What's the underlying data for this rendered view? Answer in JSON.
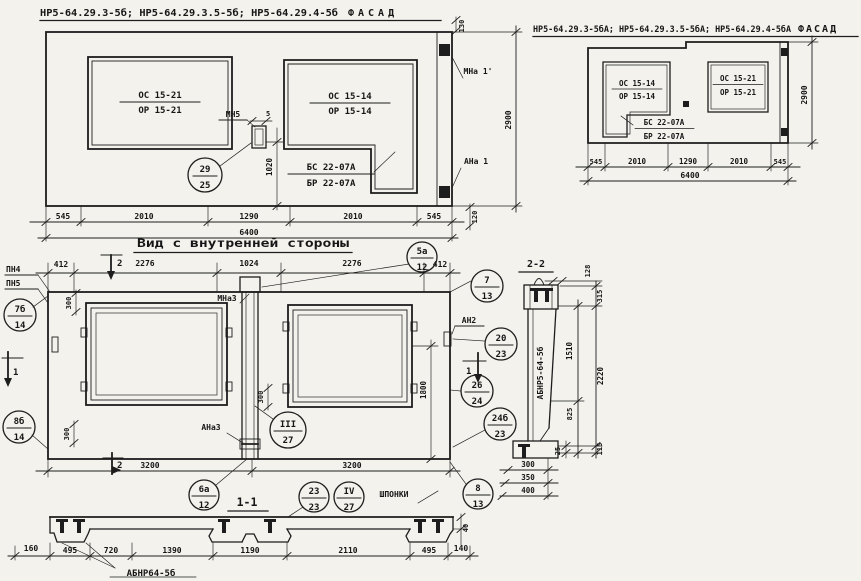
{
  "facade_a": {
    "title_codes": "НР5-64.29.3-5б; НР5-64.29.3.5-5б; НР5-64.29.4-5б",
    "title_word": "ФАСАД",
    "win_left_top": "ОС 15-21",
    "win_left_bot": "ОР 15-21",
    "win_right_top": "ОС 15-14",
    "win_right_bot": "ОР 15-14",
    "door_top": "БС 22-07А",
    "door_bot": "БР 22-07А",
    "mark_mn5": "МН5",
    "dim_5": "5",
    "dim_1020": "1020",
    "circ_top": "29",
    "circ_bot": "25",
    "mark_mna1": "МНа 1'",
    "mark_ana1": "АНа 1",
    "dim_2900": "2900",
    "dim_130": "130",
    "dim_120": "120",
    "dims": [
      "545",
      "2010",
      "1290",
      "2010",
      "545"
    ],
    "dim_total": "6400"
  },
  "facade_b": {
    "title_codes": "НР5-64.29.3-5бА; НР5-64.29.3.5-5бА; НР5-64.29.4-5бА",
    "title_word": "ФАСАД",
    "win_left_top": "ОС 15-14",
    "win_left_bot": "ОР 15-14",
    "door_top": "БС 22-07А",
    "door_bot": "БР 22-07А",
    "win_right_top": "ОС 15-21",
    "win_right_bot": "ОР 15-21",
    "dims": [
      "545",
      "2010",
      "1290",
      "2010",
      "545"
    ],
    "dim_total": "6400",
    "dim_2900": "2900"
  },
  "inner": {
    "title": "Вид с внутренней стороны",
    "dims_top": [
      "412",
      "2276",
      "1024",
      "2276",
      "412"
    ],
    "dims_bottom": [
      "3200",
      "3200"
    ],
    "mark_pn4": "ПН4",
    "mark_pn5": "ПН5",
    "mark_mna3": "МНа3",
    "mark_ana3": "АНа3",
    "mark_an2": "АН2",
    "label_shponki": "ШПОНКИ",
    "dim_300_a": "300",
    "dim_300_b": "300",
    "dim_300_c": "300",
    "dim_1800": "1800",
    "sec_mark_1": "1",
    "sec_mark_2": "2",
    "c5a": [
      "5а",
      "12"
    ],
    "c7": [
      "7",
      "13"
    ],
    "c7b": [
      "7б",
      "14"
    ],
    "c8b": [
      "8б",
      "14"
    ],
    "c20": [
      "20",
      "23"
    ],
    "c26": [
      "26",
      "24"
    ],
    "c24b": [
      "24б",
      "23"
    ],
    "c3": [
      "III",
      "27"
    ],
    "c6a": [
      "6а",
      "12"
    ],
    "c23": [
      "23",
      "23"
    ],
    "c4": [
      "IV",
      "27"
    ],
    "c8": [
      "8",
      "13"
    ],
    "sec11_title": "1-1"
  },
  "sec22": {
    "title": "2-2",
    "label": "АБНР5-64-5б",
    "d128": "128",
    "d315": "315",
    "d1510": "1510",
    "d2220": "2220",
    "d825": "825",
    "d25": "25",
    "d115": "115",
    "dims_bottom": [
      "300",
      "350",
      "400"
    ]
  },
  "sec11": {
    "label": "АБНР64-5б",
    "dims": [
      "160",
      "495",
      "720",
      "1390",
      "1190",
      "2110",
      "495",
      "140"
    ],
    "d40": "40"
  }
}
